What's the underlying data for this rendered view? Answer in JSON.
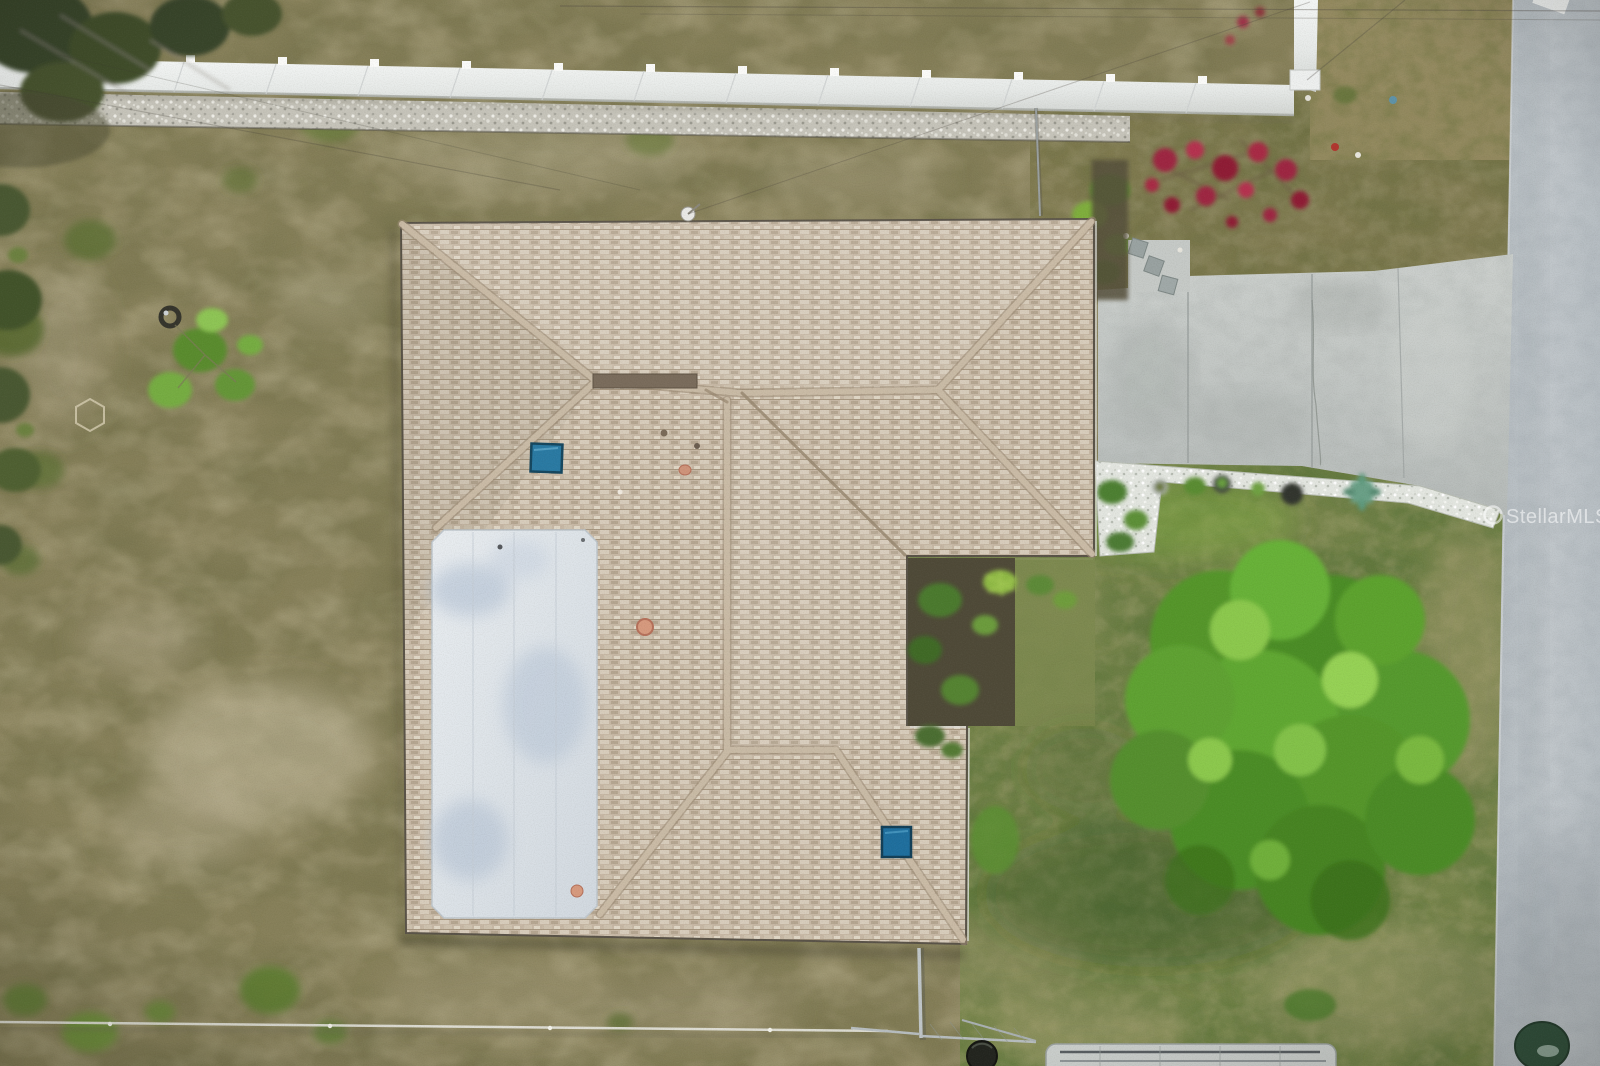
{
  "watermark": {
    "text": "StellarMLS"
  },
  "palette": {
    "roof_shingle": "#c7b8a5",
    "roof_ridge_cap": "#cbbda8",
    "flat_roof_white": "#e3e8ec",
    "skylight_blue": "#1f6f9e",
    "driveway_concrete": "#c3c7c4",
    "road_asphalt": "#b9c0c5",
    "front_lawn_green": "#75844a",
    "backyard_scrub": "#87805a",
    "vinyl_fence_white": "#eef0ef",
    "tree_canopy_green": "#55962b",
    "flower_red": "#a32b44",
    "rock_bed_white": "#e3e6e0",
    "terracotta_vent": "#d79a7e"
  }
}
